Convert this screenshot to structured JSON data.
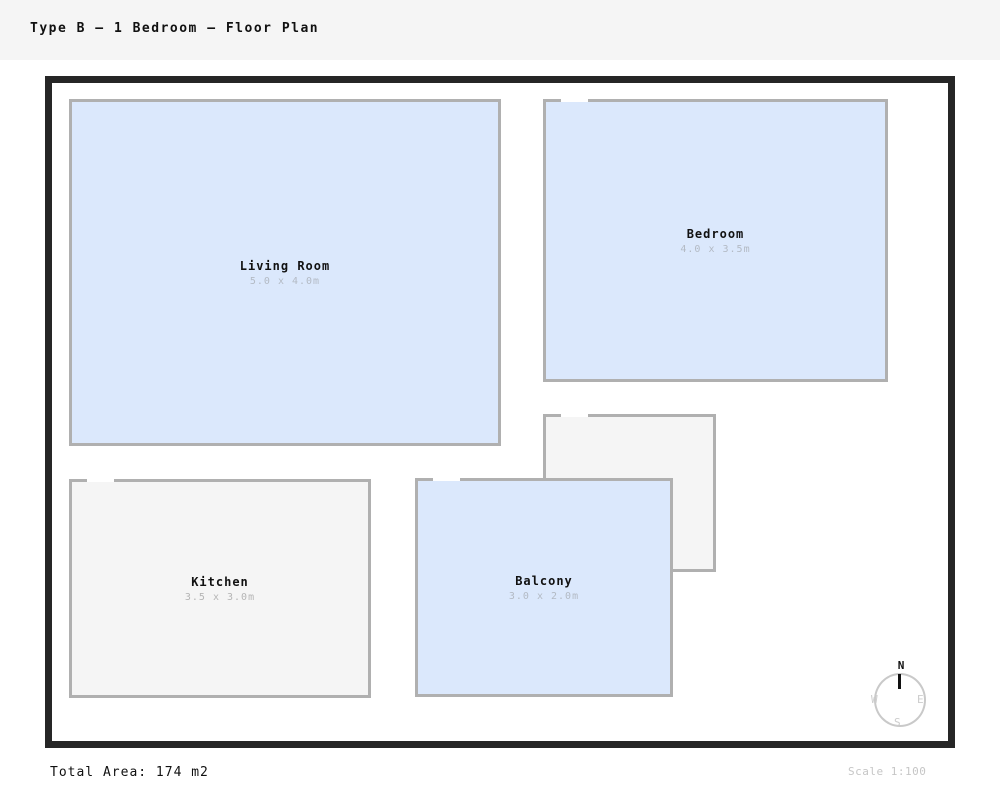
{
  "header": {
    "title": "Type B – 1 Bedroom – Floor Plan"
  },
  "rooms": [
    {
      "name": "Living Room",
      "dims": "5.0 x 4.0m",
      "fill": "#dbe8fc",
      "has_door_gap": false
    },
    {
      "name": "Bedroom",
      "dims": "4.0 x 3.5m",
      "fill": "#dbe8fc",
      "has_door_gap": true
    },
    {
      "name": "",
      "dims": "",
      "fill": "#f5f5f5",
      "has_door_gap": true
    },
    {
      "name": "Kitchen",
      "dims": "3.5 x 3.0m",
      "fill": "#f5f5f5",
      "has_door_gap": true
    },
    {
      "name": "Balcony",
      "dims": "3.0 x 2.0m",
      "fill": "#dbe8fc",
      "has_door_gap": true
    }
  ],
  "compass": {
    "north": "N",
    "west": "W",
    "east": "E",
    "south": "S"
  },
  "footer": {
    "total_area": "Total Area: 174 m2",
    "scale": "Scale 1:100"
  },
  "colors": {
    "header_bg": "#f5f5f5",
    "frame_border": "#262626",
    "room_border": "#b0b0b0",
    "room_fill_blue": "#dbe8fc",
    "room_fill_gray": "#f5f5f5",
    "dim_text_on_blue": "#b3bac4",
    "dim_text_on_gray": "#b5b5b5",
    "muted_text": "#c6c6c6"
  }
}
